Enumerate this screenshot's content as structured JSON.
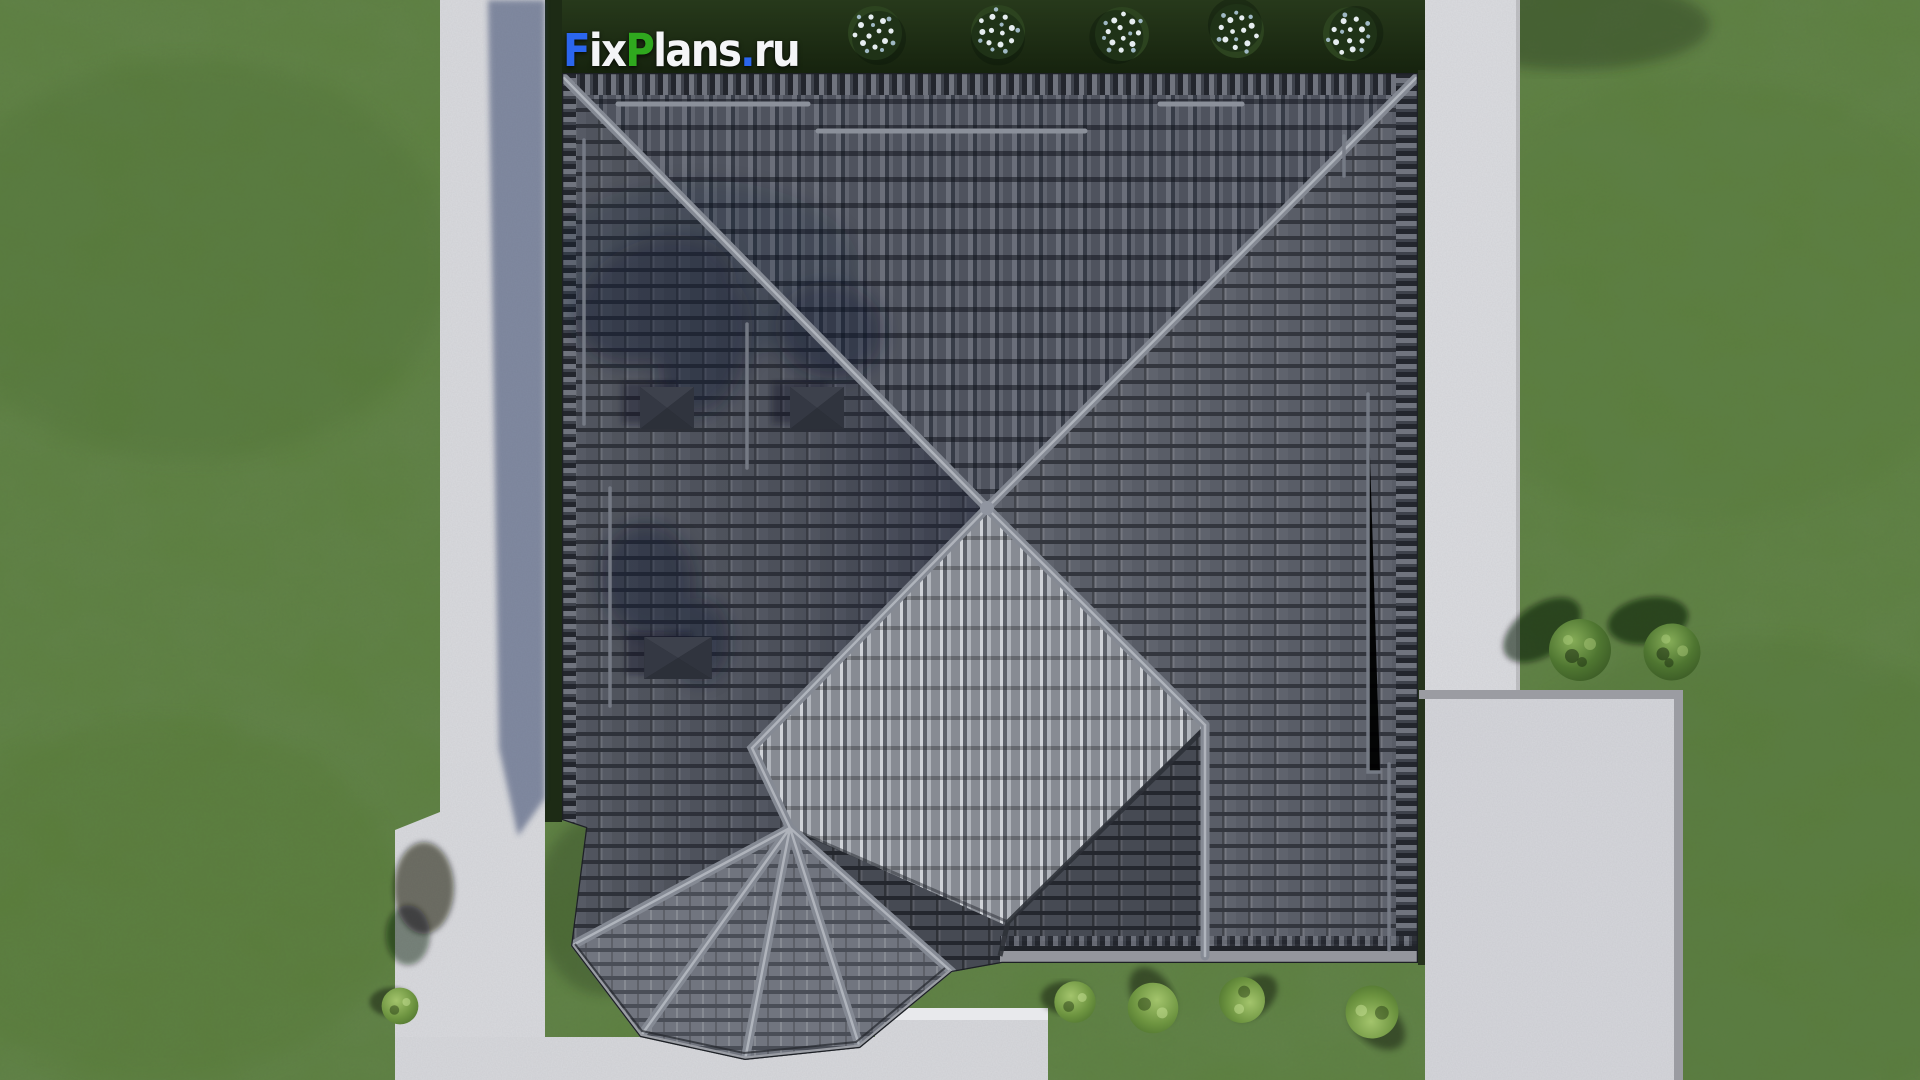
{
  "watermark": {
    "text": "FixPlans.ru",
    "parts": {
      "f": "F",
      "i": "i",
      "x": "x",
      "p": "P",
      "lans": "lans",
      "dot": ".",
      "ru": "ru"
    }
  },
  "palette": {
    "lawn_green": "#5E8141",
    "lawn_mottle_dark": "#33501F",
    "hedge_shadow_green": "#1D2B15",
    "concrete_light": "#D6D7DB",
    "concrete_curb": "#9B9CA2",
    "roof_tile_dark": "#454952",
    "roof_tile_mid": "#575B65",
    "roof_tile_bright": "#8F939B",
    "ridge_gray": "#858A94",
    "logo_blue": "#2B66EE",
    "logo_green": "#2FA81E",
    "logo_white": "#F4F5F7"
  },
  "scene": {
    "flowering_bushes_top": 5,
    "green_bushes_right": 2,
    "green_bushes_bottom": 4,
    "skylights": 3
  }
}
